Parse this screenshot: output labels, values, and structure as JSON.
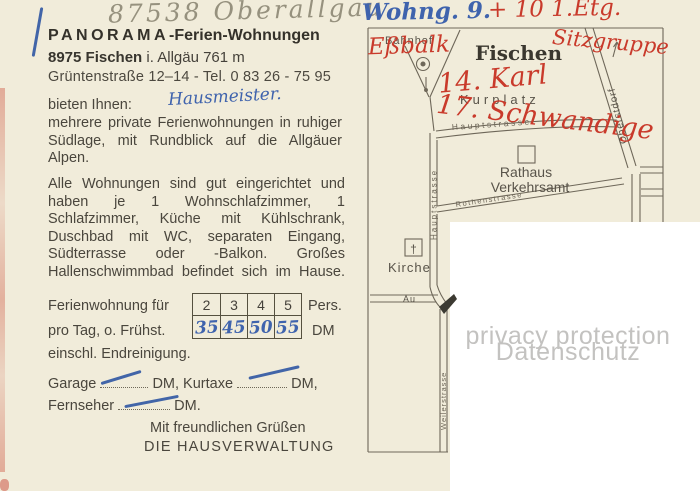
{
  "postcard": {
    "pencil_note": "87538 Oberallgäu",
    "header": {
      "title_emph": "PANORAMA",
      "title_rest": "-Ferien-Wohnungen",
      "address_bold": "8975 Fischen",
      "address_rest": " i. Allgäu 761 m",
      "street_phone": "Grüntenstraße 12–14 - Tel. 0 83 26 - 75 95"
    },
    "intro_label": "bieten Ihnen:",
    "handwritten_intro": "Hausmeister.",
    "paragraph1": "mehrere private Ferienwohnungen in ruhiger Südlage, mit Rundblick auf die Allgäuer Alpen.",
    "paragraph2": "Alle Wohnungen sind gut eingerichtet und haben je 1 Wohnschlafzimmer, 1 Schlafzimmer, Küche mit Kühlschrank, Duschbad mit WC, separaten Eingang, Südterrasse oder -Balkon. Großes Hallenschwimmbad befindet sich im Hause.",
    "price_table": {
      "row1_label": "Ferienwohnung für",
      "row2_label": "pro Tag, o. Frühst.",
      "row3_label": "einschl. Endreinigung.",
      "persons": [
        "2",
        "3",
        "4",
        "5"
      ],
      "persons_unit": "Pers.",
      "prices_handwritten": [
        "35",
        "45",
        "50",
        "55"
      ],
      "price_unit": "DM"
    },
    "fees": {
      "garage_label": "Garage",
      "garage_unit": "DM, Kurtaxe",
      "kurtaxe_unit": "DM,",
      "tv_label": "Fernseher",
      "tv_unit": "DM."
    },
    "closing_line1": "Mit freundlichen Grüßen",
    "closing_line2": "DIE HAUSVERWALTUNG"
  },
  "map": {
    "town": "Fischen",
    "labels": {
      "bahnhof": "Bahnhof",
      "kurplatz": "Kurplatz",
      "hauptstrasse_h": "Hauptstrasse",
      "hauptstrasse_v": "Hauptstrasse",
      "rathaus_line1": "Rathaus",
      "rathaus_line2": "Verkehrsamt",
      "rothenstrasse": "Rothenstrasse",
      "oberstdorf": "Oberstdorf",
      "kirche": "Kirche",
      "church_cross": "†",
      "au": "Au",
      "weilerstrasse": "Weilerstrasse"
    }
  },
  "annotations": {
    "blue_top": "Wohng. 9.",
    "red_top": "+ 10 1.Etg.",
    "red_note1": "Eßbalk",
    "red_note2": "Sitzgruppe",
    "red_note3": "14. Karl",
    "red_note4": "17. Schwandige"
  },
  "watermark": {
    "line1": "privacy protection",
    "line2": "Datenschutz"
  },
  "colors": {
    "paper": "#f1ecda",
    "ink": "#45413a",
    "blue_ink": "#3f63ad",
    "red_ink": "#c93a2b",
    "pencil": "#96917e",
    "map_line": "#6e6759",
    "watermark": "#c3c2c0"
  }
}
